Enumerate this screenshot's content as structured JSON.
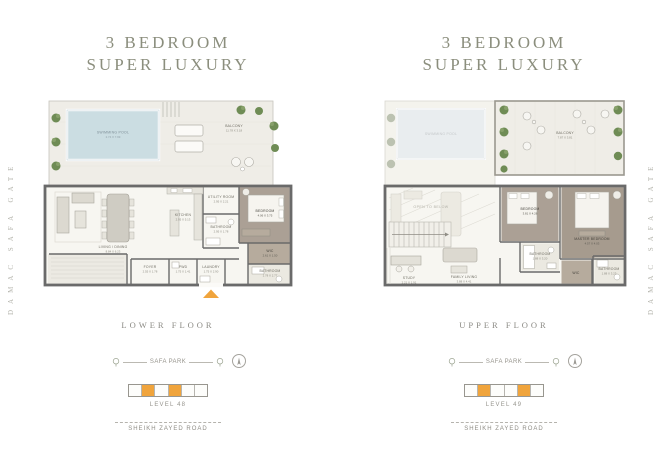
{
  "colors": {
    "accent_orange": "#F0A43C",
    "pool_blue": "#CBDDE2",
    "wall_gray": "#6A6A6A",
    "bedroom_floor_brown": "#ABA095",
    "title_olive": "#8B8E7D",
    "plant_green": "#6F8C55"
  },
  "side_labels": {
    "left": "DAMAC SAFA GATE",
    "right": "DAMAC SAFA GATE"
  },
  "lower": {
    "title_line1": "3 BEDROOM",
    "title_line2": "SUPER LUXURY",
    "floor_label": "LOWER FLOOR",
    "level_label": "LEVEL 48",
    "park_label": "SAFA PARK",
    "road_label": "SHEIKH ZAYED ROAD",
    "rooms": {
      "pool": {
        "name": "SWIMMING POOL",
        "dims": "2.74 X 7.99"
      },
      "balcony": {
        "name": "BALCONY",
        "dims": "11.78 X 3.18"
      },
      "living": {
        "name": "LIVING / DINING",
        "dims": "8.84 X 6.23"
      },
      "kitchen": {
        "name": "KITCHEN",
        "dims": "2.95 X 5.13"
      },
      "utility": {
        "name": "UTILITY ROOM",
        "dims": "2.95 X 2.21"
      },
      "bathroom": {
        "name": "BATHROOM",
        "dims": "2.95 X 1.78"
      },
      "bedroom": {
        "name": "BEDROOM",
        "dims": "4.06 X 3.75"
      },
      "wic": {
        "name": "WIC",
        "dims": "2.61 X 1.50"
      },
      "foyer": {
        "name": "FOYER",
        "dims": "2.55 X 1.78"
      },
      "powder": {
        "name": "PWD",
        "dims": "1.75 X 1.41"
      },
      "laundry": {
        "name": "LAUNDRY",
        "dims": "1.75 X 2.90"
      },
      "bathroom2": {
        "name": "BATHROOM",
        "dims": "1.78 X 2.77"
      }
    }
  },
  "upper": {
    "title_line1": "3 BEDROOM",
    "title_line2": "SUPER LUXURY",
    "floor_label": "UPPER FLOOR",
    "level_label": "LEVEL 49",
    "park_label": "SAFA PARK",
    "road_label": "SHEIKH ZAYED ROAD",
    "rooms": {
      "pool_ghost": {
        "name": "SWIMMING POOL"
      },
      "balcony": {
        "name": "BALCONY",
        "dims": "7.87 X 3.81"
      },
      "open_below": {
        "name": "OPEN TO BELOW"
      },
      "bedroom": {
        "name": "BEDROOM",
        "dims": "3.81 X 4.26"
      },
      "master": {
        "name": "MASTER BEDROOM",
        "dims": "4.57 X 4.03"
      },
      "bathroom": {
        "name": "BATHROOM",
        "dims": "1.88 X 3.20"
      },
      "wic": {
        "name": "WIC"
      },
      "bathroom2": {
        "name": "BATHROOM",
        "dims": "1.88 X 3.23"
      },
      "study": {
        "name": "STUDY",
        "dims": "2.21 X 1.91"
      },
      "family": {
        "name": "FAMILY LIVING",
        "dims": "3.88 X 4.41"
      }
    }
  }
}
